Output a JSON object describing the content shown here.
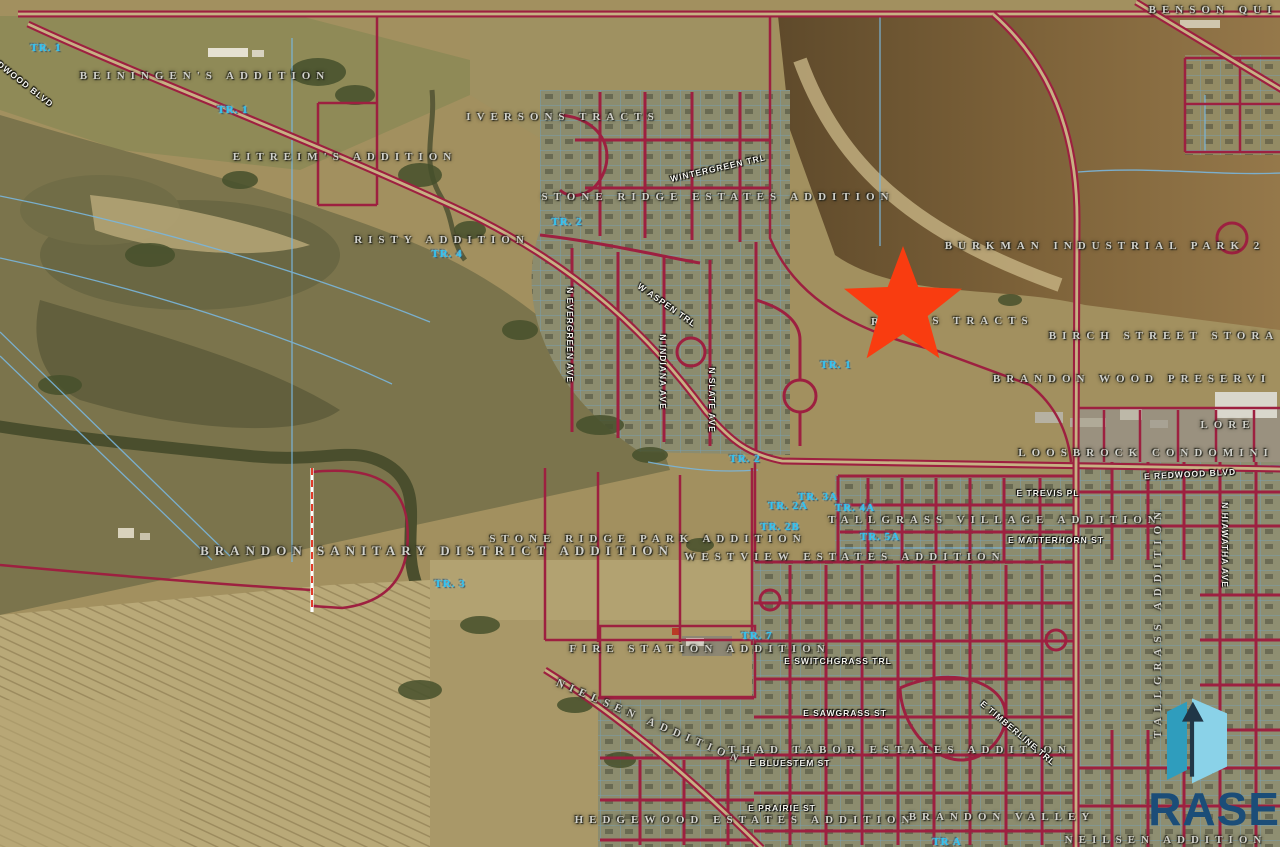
{
  "map": {
    "star": {
      "x": 903,
      "y": 308,
      "color": "#f93c10"
    },
    "colors": {
      "parcel_line": "#9d2040",
      "survey_line": "#7ab6db",
      "road_core": "#c8b184",
      "dashed_line": "#e23b2a",
      "terrain_base": "#a2905f"
    },
    "labels": [
      {
        "text": "BENSON QUI",
        "type": "addition",
        "x": 1213,
        "y": 10
      },
      {
        "text": "BEININGEN'S ADDITION",
        "type": "addition",
        "x": 205,
        "y": 76
      },
      {
        "text": "IVERSONS TRACTS",
        "type": "addition",
        "x": 563,
        "y": 117
      },
      {
        "text": "EITREIM'S ADDITION",
        "type": "addition",
        "x": 345,
        "y": 157
      },
      {
        "text": "STONE RIDGE ESTATES ADDITION",
        "type": "addition",
        "x": 718,
        "y": 197
      },
      {
        "text": "RISTY ADDITION",
        "type": "addition",
        "x": 442,
        "y": 240
      },
      {
        "text": "BURKMAN INDUSTRIAL PARK 2",
        "type": "addition",
        "x": 1105,
        "y": 246
      },
      {
        "text": "R",
        "type": "addition",
        "x": 878,
        "y": 322
      },
      {
        "text": "S TRACTS",
        "type": "addition",
        "x": 983,
        "y": 321
      },
      {
        "text": "BIRCH STREET STORA",
        "type": "addition",
        "x": 1164,
        "y": 336
      },
      {
        "text": "BRANDON WOOD PRESERVI",
        "type": "addition",
        "x": 1132,
        "y": 379
      },
      {
        "text": "LORE",
        "type": "addition",
        "x": 1228,
        "y": 425
      },
      {
        "text": "LOOSBROCK CONDOMINI",
        "type": "addition",
        "x": 1146,
        "y": 453
      },
      {
        "text": "TALLGRASS VILLAGE ADDITION",
        "type": "addition",
        "x": 995,
        "y": 520
      },
      {
        "text": "STONE RIDGE PARK ADDITION",
        "type": "addition",
        "x": 648,
        "y": 539
      },
      {
        "text": "BRANDON SANITARY DISTRICT ADDITION",
        "type": "addition",
        "x": 437,
        "y": 551,
        "size": 13
      },
      {
        "text": "WESTVIEW ESTATES ADDITION",
        "type": "addition",
        "x": 845,
        "y": 557
      },
      {
        "text": "FIRE STATION ADDITION",
        "type": "addition",
        "x": 700,
        "y": 649
      },
      {
        "text": "NIELSEN ADDITION",
        "type": "addition",
        "x": 650,
        "y": 722,
        "rotate": 23
      },
      {
        "text": "THAD TABOR ESTATES ADDITION",
        "type": "addition",
        "x": 900,
        "y": 750
      },
      {
        "text": "HEDGEWOOD ESTATES ADDITION",
        "type": "addition",
        "x": 745,
        "y": 820
      },
      {
        "text": "BRANDON VALLEY",
        "type": "addition",
        "x": 1002,
        "y": 817
      },
      {
        "text": "NEILSEN ADDITION",
        "type": "addition",
        "x": 1166,
        "y": 840
      },
      {
        "text": "TALLGRASS ADDITION",
        "type": "addition",
        "x": 1158,
        "y": 622,
        "rotate": -90
      },
      {
        "text": "TR. 1",
        "type": "tract",
        "x": 46,
        "y": 48
      },
      {
        "text": "TR. 1",
        "type": "tract",
        "x": 233,
        "y": 110
      },
      {
        "text": "TR. 2",
        "type": "tract",
        "x": 567,
        "y": 222
      },
      {
        "text": "TR. 4",
        "type": "tract",
        "x": 447,
        "y": 254
      },
      {
        "text": "TR. 1",
        "type": "tract",
        "x": 836,
        "y": 365
      },
      {
        "text": "TR. 2",
        "type": "tract",
        "x": 745,
        "y": 459
      },
      {
        "text": "TR. 3A",
        "type": "tract",
        "x": 818,
        "y": 497
      },
      {
        "text": "TR. 2A",
        "type": "tract",
        "x": 788,
        "y": 506
      },
      {
        "text": "TR. 4A",
        "type": "tract",
        "x": 855,
        "y": 508
      },
      {
        "text": "TR. 2B",
        "type": "tract",
        "x": 780,
        "y": 527
      },
      {
        "text": "TR. 5A",
        "type": "tract",
        "x": 880,
        "y": 537
      },
      {
        "text": "TR. 3",
        "type": "tract",
        "x": 450,
        "y": 584
      },
      {
        "text": "TR. 7",
        "type": "tract",
        "x": 757,
        "y": 636
      },
      {
        "text": "TR A",
        "type": "tract",
        "x": 947,
        "y": 842
      },
      {
        "text": "REDWOOD BLVD",
        "type": "street",
        "x": 20,
        "y": 80,
        "rotate": 38
      },
      {
        "text": "WINTERGREEN TRL",
        "type": "street",
        "x": 718,
        "y": 168,
        "rotate": -13
      },
      {
        "text": "W ASPEN TRL",
        "type": "street",
        "x": 667,
        "y": 305,
        "rotate": 35
      },
      {
        "text": "N EVERGREEN AVE",
        "type": "street",
        "x": 570,
        "y": 335,
        "rotate": 90
      },
      {
        "text": "N INDIANA AVE",
        "type": "street",
        "x": 663,
        "y": 372,
        "rotate": 90
      },
      {
        "text": "N SLATE AVE",
        "type": "street",
        "x": 712,
        "y": 400,
        "rotate": 90
      },
      {
        "text": "E REDWOOD BLVD",
        "type": "street",
        "x": 1190,
        "y": 474,
        "rotate": -3
      },
      {
        "text": "E TREVIS PL",
        "type": "street",
        "x": 1048,
        "y": 493
      },
      {
        "text": "E MATTERHORN ST",
        "type": "street",
        "x": 1056,
        "y": 540
      },
      {
        "text": "N HIAWATHA AVE",
        "type": "street",
        "x": 1225,
        "y": 545,
        "rotate": 90
      },
      {
        "text": "E SWITCHGRASS TRL",
        "type": "street",
        "x": 838,
        "y": 661
      },
      {
        "text": "E SAWGRASS ST",
        "type": "street",
        "x": 845,
        "y": 713
      },
      {
        "text": "E TIMBERLINE TRL",
        "type": "street",
        "x": 1018,
        "y": 733,
        "rotate": 40
      },
      {
        "text": "E BLUESTEM ST",
        "type": "street",
        "x": 790,
        "y": 763
      },
      {
        "text": "E PRAIRIE ST",
        "type": "street",
        "x": 782,
        "y": 808
      }
    ]
  },
  "logo": {
    "text": "RASE",
    "colors": {
      "icon_left": "#2f9dbd",
      "icon_right": "#8ad2e8",
      "icon_arrow": "#203647",
      "text_color": "#1b4d78"
    }
  }
}
